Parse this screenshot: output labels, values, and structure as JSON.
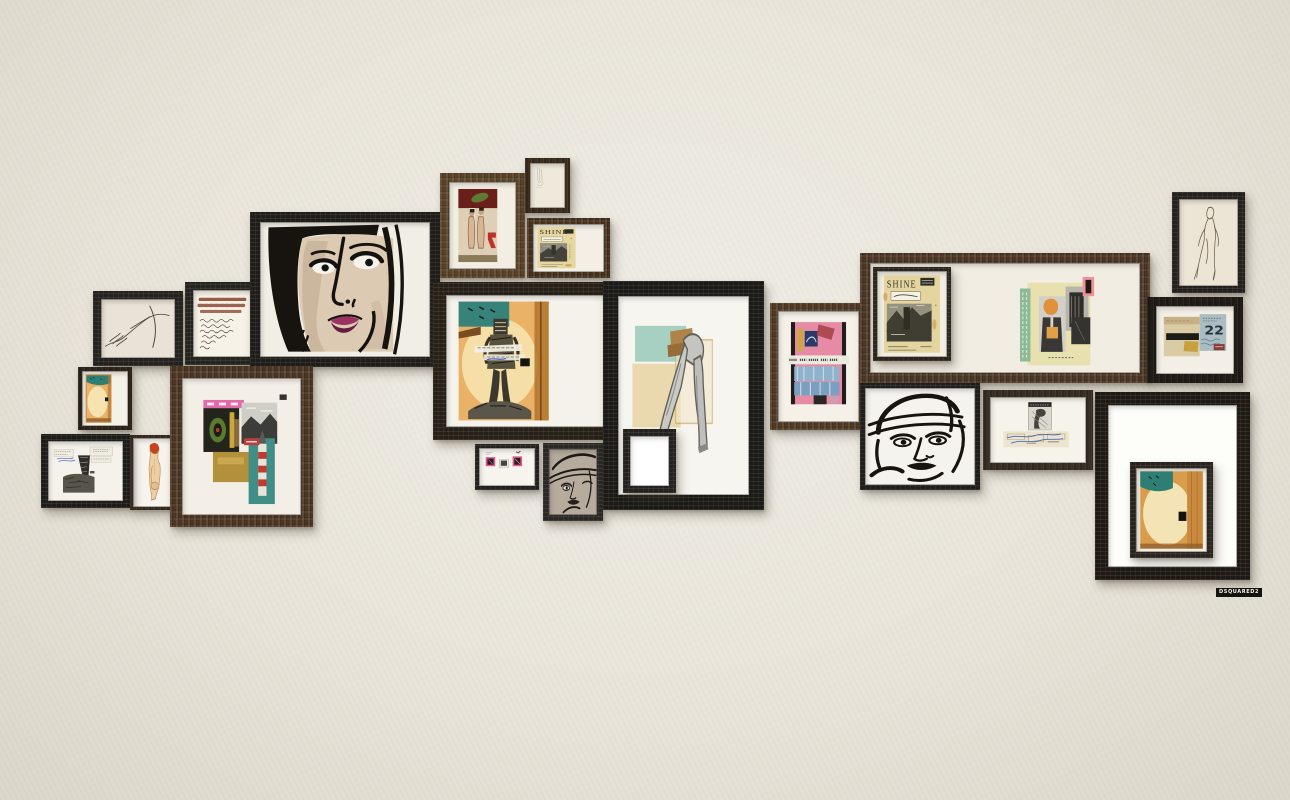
{
  "brand": {
    "logo": "DSQUARED2"
  },
  "wall": {
    "color": "#e9e5da"
  },
  "texts": {
    "shine": "SHINE",
    "number22": "22"
  },
  "frames": [
    {
      "name": "frame-hands-sketch",
      "label": "charcoal line drawing of hands",
      "x": 93,
      "y": 291,
      "w": 90,
      "h": 75,
      "border": 8,
      "style": "black",
      "frame_color": "#242220",
      "inner_color": "#e9e2d6",
      "art": "hands"
    },
    {
      "name": "frame-handwriting",
      "label": "handwritten letter with rust-red strokes",
      "x": 185,
      "y": 282,
      "w": 75,
      "h": 83,
      "border": 8,
      "style": "black",
      "frame_color": "#262421",
      "inner_color": "#f6f2e7",
      "art": "handwriting"
    },
    {
      "name": "frame-big-face",
      "label": "ink portrait of woman with bob haircut",
      "x": 250,
      "y": 212,
      "w": 190,
      "h": 155,
      "border": 10,
      "style": "black",
      "frame_color": "#1f1d1b",
      "inner_color": "#f1eee5",
      "art": "bigface"
    },
    {
      "name": "frame-orange-card",
      "label": "burnt orange card with teal corner",
      "x": 78,
      "y": 367,
      "w": 54,
      "h": 63,
      "border": 4,
      "style": "dark",
      "frame_color": "#2e251d",
      "inner_color": "#f4f1e8",
      "art": "orangecard"
    },
    {
      "name": "frame-redhead-nude",
      "label": "watercolor nude with red hair",
      "x": 130,
      "y": 435,
      "w": 48,
      "h": 75,
      "border": 3,
      "style": "dark",
      "frame_color": "#3a2d20",
      "inner_color": "#f7f4ed",
      "art": "redhead"
    },
    {
      "name": "frame-legs-sketch",
      "label": "black and white figure sketch with clippings",
      "x": 41,
      "y": 434,
      "w": 89,
      "h": 74,
      "border": 7,
      "style": "black",
      "frame_color": "#1d1c1a",
      "inner_color": "#f5f2eb",
      "art": "legsphoto"
    },
    {
      "name": "frame-rocket-collage",
      "label": "mixed media collage with rocket",
      "x": 170,
      "y": 366,
      "w": 143,
      "h": 161,
      "border": 12,
      "style": "wood",
      "frame_color": "#4b3524",
      "inner_color": "#f3efe6",
      "art": "rocketcollage"
    },
    {
      "name": "frame-two-nudes",
      "label": "painting of two standing nudes",
      "x": 440,
      "y": 173,
      "w": 85,
      "h": 105,
      "border": 9,
      "style": "wood",
      "frame_color": "#57422a",
      "inner_color": "#f2eee3",
      "art": "twonudes"
    },
    {
      "name": "frame-faint-sketch",
      "label": "small faint pencil sketch",
      "x": 525,
      "y": 158,
      "w": 45,
      "h": 55,
      "border": 5,
      "style": "dark",
      "frame_color": "#3c2d1f",
      "inner_color": "#efe9db",
      "art": "faintsketch"
    },
    {
      "name": "frame-shine-page",
      "label": "vintage SHINE magazine page",
      "x": 527,
      "y": 218,
      "w": 83,
      "h": 60,
      "border": 6,
      "style": "wood",
      "frame_color": "#46311f",
      "inner_color": "#f3efe6",
      "art": "shinepage"
    },
    {
      "name": "frame-figure-on-burnt",
      "label": "collage figure on burnt orange paper",
      "x": 433,
      "y": 282,
      "w": 184,
      "h": 158,
      "border": 13,
      "style": "black",
      "frame_color": "#262019",
      "inner_color": "#f5f2eb",
      "art": "figureonburnt"
    },
    {
      "name": "frame-stamps",
      "label": "three pink and black stamp collage",
      "x": 475,
      "y": 444,
      "w": 64,
      "h": 46,
      "border": 4,
      "style": "black",
      "frame_color": "#232120",
      "inner_color": "#f7f4ed",
      "art": "stamps"
    },
    {
      "name": "frame-half-face",
      "label": "cropped ink face with cap",
      "x": 543,
      "y": 443,
      "w": 60,
      "h": 78,
      "border": 6,
      "style": "black",
      "frame_color": "#2a2826",
      "inner_color": "#b7ab9e",
      "art": "halfface"
    },
    {
      "name": "frame-walking-legs",
      "label": "collage of walking legs with teal and cream blocks",
      "x": 603,
      "y": 281,
      "w": 161,
      "h": 229,
      "border": 15,
      "style": "black",
      "frame_color": "#1b1a18",
      "inner_color": "#f7f5ef",
      "art": "walkinglegs"
    },
    {
      "name": "frame-small-mirror",
      "label": "small empty white frame",
      "x": 623,
      "y": 429,
      "w": 53,
      "h": 64,
      "border": 7,
      "style": "black",
      "frame_color": "#242221",
      "inner_color": "#ffffff",
      "art": "blank"
    },
    {
      "name": "frame-pink-blue-collage",
      "label": "pink and denim blue collage",
      "x": 770,
      "y": 303,
      "w": 97,
      "h": 127,
      "border": 8,
      "style": "wood",
      "frame_color": "#4e3a27",
      "inner_color": "#f5f1e9",
      "art": "pinkblue"
    },
    {
      "name": "frame-wide-composite",
      "label": "wide frame with SHINE cover and fashion collage",
      "x": 860,
      "y": 253,
      "w": 290,
      "h": 130,
      "border": 10,
      "style": "wood",
      "frame_color": "#4a3626",
      "inner_color": "#f1ede2",
      "art": "blank",
      "kids": [
        {
          "name": "frame-shine-cover",
          "label": "framed SHINE magazine cover",
          "x": 3,
          "y": 4,
          "w": 78,
          "h": 94,
          "border": 4,
          "style": "black",
          "frame_color": "#2a241e",
          "inner_color": "#f1ede2",
          "art": "shinecover"
        },
        {
          "name": "collage-fashion",
          "label": "fashion photo collage",
          "x": 150,
          "y": 14,
          "w": 95,
          "h": 96,
          "border": 0,
          "style": "flat",
          "art": "fashioncollage"
        }
      ]
    },
    {
      "name": "frame-helmet-face",
      "label": "ink portrait with aviator helmet",
      "x": 860,
      "y": 383,
      "w": 120,
      "h": 107,
      "border": 5,
      "style": "black",
      "frame_color": "#201e1c",
      "inner_color": "#f5f3ed",
      "art": "helmetface"
    },
    {
      "name": "frame-figure-scribble",
      "label": "small collage with blue scribbles",
      "x": 983,
      "y": 390,
      "w": 110,
      "h": 80,
      "border": 7,
      "style": "dark",
      "frame_color": "#382f26",
      "inner_color": "#f6f3eb",
      "art": "figurescribble"
    },
    {
      "name": "frame-standing-figure",
      "label": "thin line drawing of standing figure",
      "x": 1172,
      "y": 192,
      "w": 73,
      "h": 101,
      "border": 7,
      "style": "black",
      "frame_color": "#232120",
      "inner_color": "#ece4d4",
      "art": "standingfigure"
    },
    {
      "name": "frame-collage-22",
      "label": "paper collage with number 22",
      "x": 1147,
      "y": 297,
      "w": 96,
      "h": 86,
      "border": 9,
      "style": "dark",
      "frame_color": "#211c18",
      "inner_color": "#f3efe6",
      "art": "collage22"
    },
    {
      "name": "frame-big-inner",
      "label": "large dark frame holding a smaller framed orange artwork",
      "x": 1095,
      "y": 392,
      "w": 155,
      "h": 188,
      "border": 13,
      "style": "black",
      "frame_color": "#1e1915",
      "inner_color": "#fdfdfa",
      "art": "blank",
      "kids": [
        {
          "name": "frame-inner-orange",
          "label": "small framed burnt orange artwork",
          "x": 22,
          "y": 57,
          "w": 83,
          "h": 96,
          "border": 6,
          "style": "black",
          "frame_color": "#2a2420",
          "inner_color": "#f0ece1",
          "art": "orangecard2"
        }
      ]
    }
  ]
}
